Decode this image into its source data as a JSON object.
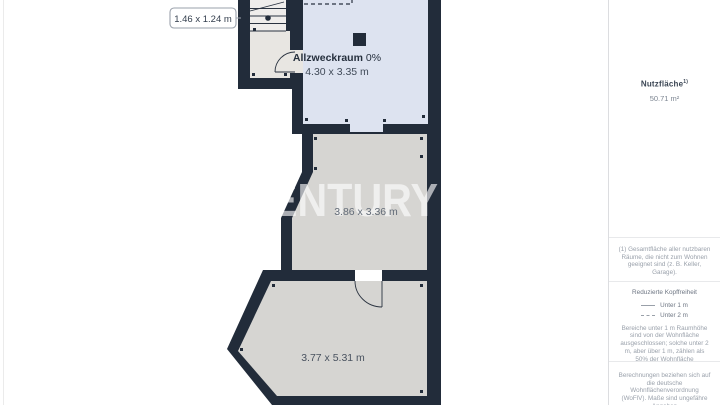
{
  "plan": {
    "watermark": "CENTURY",
    "small_room_label": "1.46 x 1.24 m",
    "rooms": {
      "allzweckraum": {
        "name": "Allzweckraum",
        "percent": "0%",
        "dimensions": "4.30 x 3.35 m"
      },
      "middle_room": {
        "dimensions": "3.86 x 3.36 m"
      },
      "bottom_room": {
        "dimensions": "3.77 x 5.31 m"
      }
    },
    "colors": {
      "wall": "#222c3a",
      "room_blue": "#dde3f0",
      "room_gray": "#d6d5d2",
      "landing_floor": "#e8e6e2",
      "stairs_floor": "#efedeb"
    }
  },
  "sidebar": {
    "area_label": "Nutzfläche",
    "area_sup": "1)",
    "area_value": "50.71 m²",
    "footnote": "(1) Gesamtfläche aller nutzbaren Räume, die nicht zum Wohnen geeignet sind (z. B. Keller, Garage).",
    "headroom": {
      "title": "Reduzierte Kopffreiheit",
      "legend": [
        {
          "style": "solid",
          "label": "Unter 1 m"
        },
        {
          "style": "dashed",
          "label": "Unter 2 m"
        }
      ],
      "note": "Bereiche unter 1 m Raumhöhe sind von der Wohnfläche ausgeschlossen; solche unter 2 m, aber über 1 m, zählen als 50% der Wohnfläche"
    },
    "disclaimer": "Berechnungen beziehen sich auf die deutsche Wohnflächenverordnung (WoFlV). Maße sind ungefähre Angaben"
  }
}
